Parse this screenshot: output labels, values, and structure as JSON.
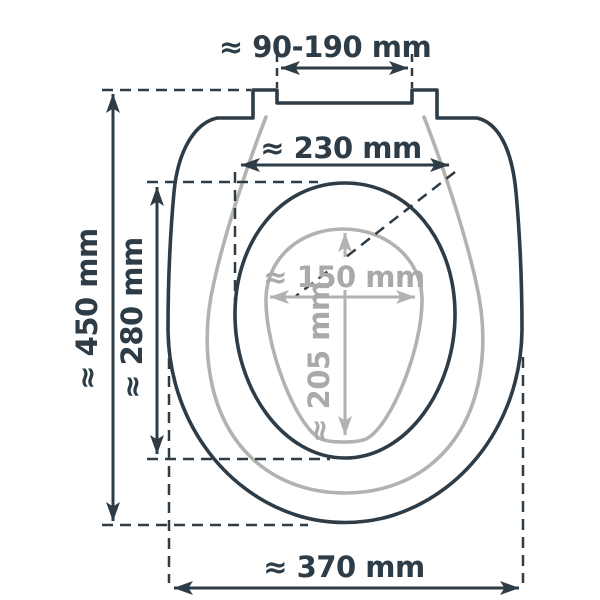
{
  "diagram": {
    "subject": "toilet-seat-dimensions",
    "unit": "mm",
    "approx_symbol": "≈",
    "colors": {
      "outline_dark": "#2d3c46",
      "outline_gray": "#b2b2b0",
      "label_dark": "#2d3c46",
      "label_gray": "#a9a9a7",
      "background": "#ffffff",
      "label_mask": "#ffffff"
    },
    "measurements": [
      {
        "id": "hinge-spacing",
        "label": "≈ 90-190 mm",
        "value": "90-190",
        "unit": "mm",
        "orientation": "horizontal",
        "color": "dark"
      },
      {
        "id": "ring-width",
        "label": "≈ 230 mm",
        "value": "230",
        "unit": "mm",
        "orientation": "horizontal",
        "color": "dark"
      },
      {
        "id": "total-length",
        "label": "≈ 450 mm",
        "value": "450",
        "unit": "mm",
        "orientation": "vertical",
        "color": "dark"
      },
      {
        "id": "ring-length",
        "label": "≈ 280 mm",
        "value": "280",
        "unit": "mm",
        "orientation": "vertical",
        "color": "dark"
      },
      {
        "id": "opening-width",
        "label": "≈ 150 mm",
        "value": "150",
        "unit": "mm",
        "orientation": "horizontal",
        "color": "gray"
      },
      {
        "id": "opening-length",
        "label": "≈ 205 mm",
        "value": "205",
        "unit": "mm",
        "orientation": "vertical",
        "color": "gray"
      },
      {
        "id": "total-width",
        "label": "≈ 370 mm",
        "value": "370",
        "unit": "mm",
        "orientation": "horizontal",
        "color": "dark"
      }
    ]
  }
}
